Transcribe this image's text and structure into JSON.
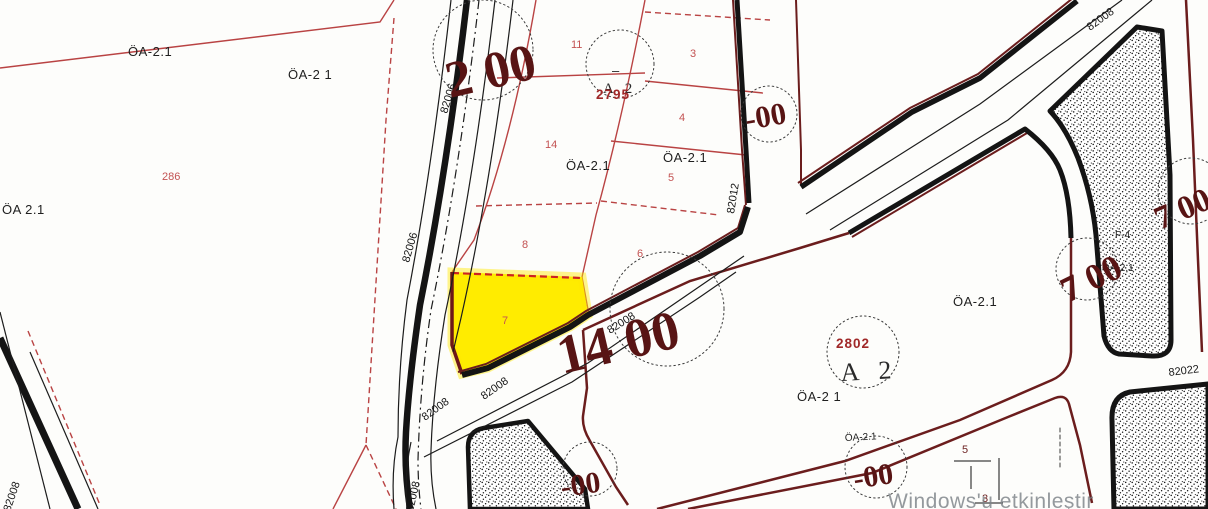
{
  "map": {
    "title": "cadastral parcel map",
    "zones": {
      "oa21": "ÖA-2.1",
      "oa21_sp": "ÖA-2 1",
      "oa21_left": "ÖA 2.1",
      "a2": "A 2",
      "f4": "F-4",
      "dash_mark": "–"
    },
    "parcels": {
      "p286": "286",
      "p11": "11",
      "p3": "3",
      "p4": "4",
      "p5": "5",
      "p14": "14",
      "p8": "8",
      "p6": "6",
      "p7": "7",
      "p5_small": "5",
      "p3_small": "3",
      "id2795": "2795",
      "id2802": "2802"
    },
    "roads": {
      "r82006": "82006",
      "r82008": "82008",
      "r82012": "82012",
      "r82022": "82022"
    },
    "measurements": {
      "m2_00": "2 00",
      "m14_00": "14 00",
      "m7_00": "7 00",
      "m_00": "-00"
    },
    "colors": {
      "highlight_parcel": "#ffec00",
      "parcel_line_red": "#b94343",
      "road_maroon": "#6b1d1d",
      "road_black": "#141414",
      "big_number": "#581414",
      "parcel_number_red": "#c35252",
      "parcel_id_red": "#a02828"
    },
    "watermark": "Windows'u etkinleştir"
  }
}
